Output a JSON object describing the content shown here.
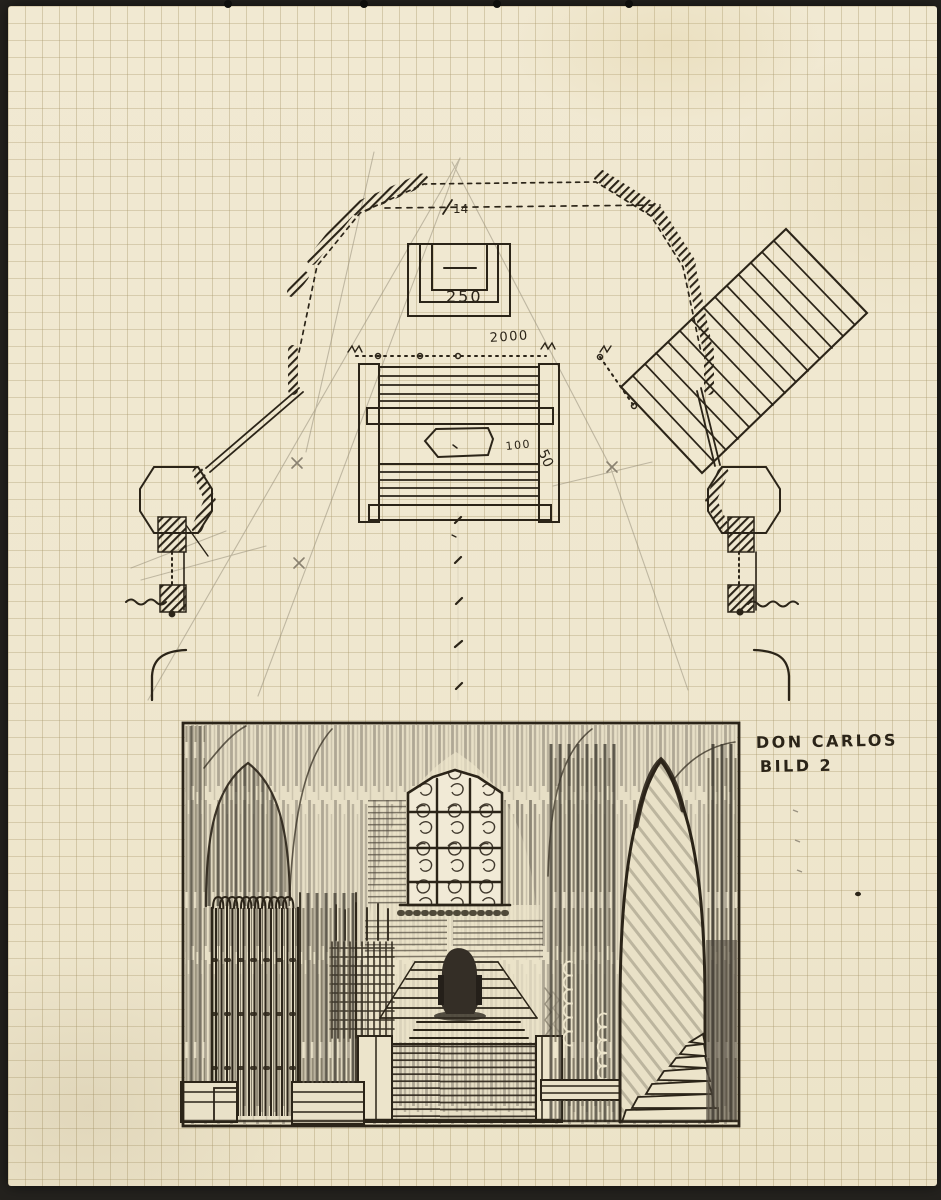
{
  "caption": {
    "line1": "DON CARLOS",
    "line2": "BILD 2"
  },
  "plan": {
    "labels": {
      "altar_steps": "250",
      "apse_width": "2000",
      "coffin": "100",
      "side": "50",
      "center": "14"
    }
  },
  "colors": {
    "paper": "#f0e8d1",
    "grid": "#a79669",
    "ink": "#2b2418",
    "pencil": "#8a8271",
    "backdrop": "#24221e"
  }
}
